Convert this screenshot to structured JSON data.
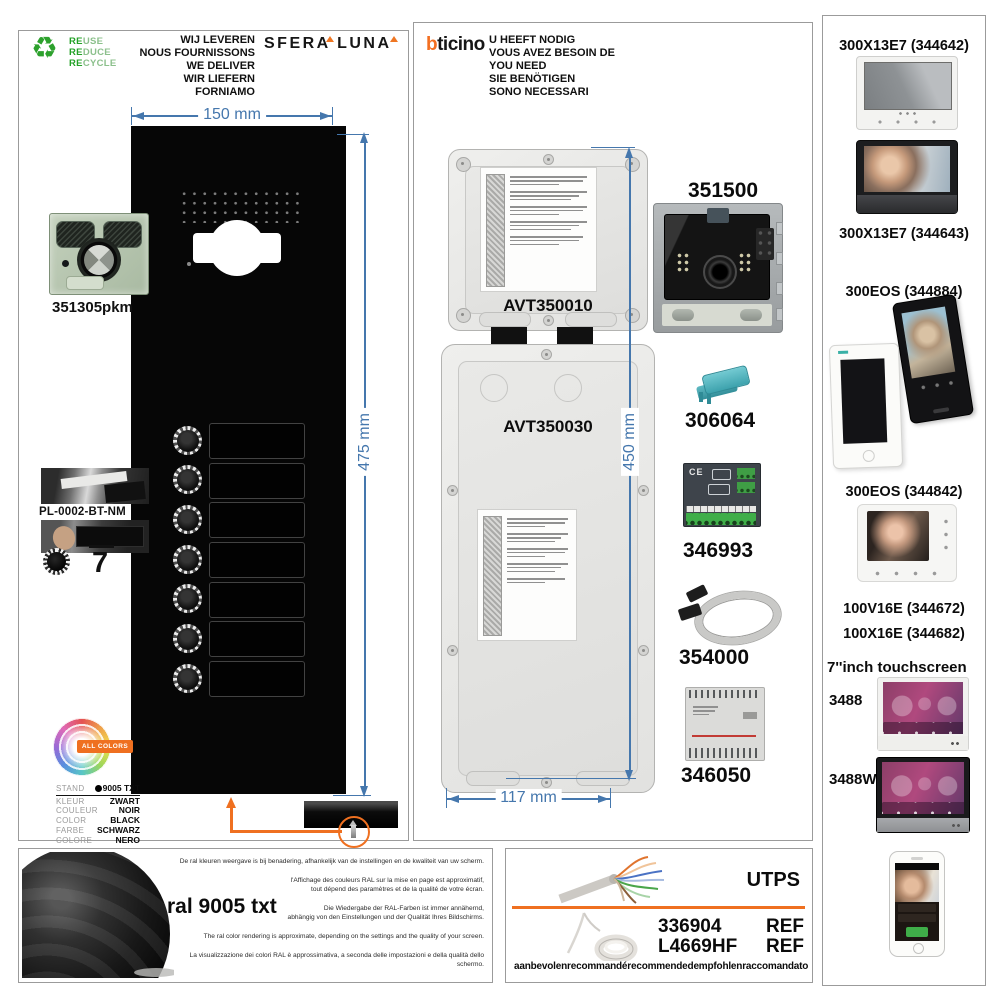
{
  "left_panel": {
    "recycle_lines": [
      {
        "prefix": "RE",
        "rest": "USE"
      },
      {
        "prefix": "RE",
        "rest": "DUCE"
      },
      {
        "prefix": "RE",
        "rest": "CYCLE"
      }
    ],
    "deliver_lines": [
      "WIJ LEVEREN",
      "NOUS FOURNISSONS",
      "WE DELIVER",
      "WIR LIEFERN",
      "FORNIAMO"
    ],
    "brand_logo": "SFERA LUNA",
    "width_dim": "150 mm",
    "height_dim": "475 mm",
    "camera_module_ref": "351305pkm",
    "nameplate_kit_ref": "PL-0002-BT-NM",
    "button_count": "7",
    "all_colors_badge": "ALL COLORS",
    "color_rows": [
      {
        "label": "STAND",
        "value": "9005 TXT"
      },
      {
        "label": "KLEUR",
        "value": "ZWART"
      },
      {
        "label": "COULEUR",
        "value": "NOIR"
      },
      {
        "label": "COLOR",
        "value": "BLACK"
      },
      {
        "label": "FARBE",
        "value": "SCHWARZ"
      },
      {
        "label": "COLORE",
        "value": "NERO"
      }
    ]
  },
  "middle_panel": {
    "brand_logo": {
      "first_letter": "b",
      "rest": "ticino"
    },
    "need_lines": [
      "U HEEFT NODIG",
      "VOUS AVEZ BESOIN DE",
      "YOU NEED",
      "SIE BENÖTIGEN",
      "SONO NECESSARI"
    ],
    "box_top_ref": "AVT350010",
    "box_bottom_ref": "AVT350030",
    "height_dim": "450 mm",
    "width_dim": "117 mm",
    "pcb_ce_mark": "CE",
    "parts": [
      "351500",
      "306064",
      "346993",
      "354000",
      "346050"
    ]
  },
  "right_panel": {
    "items": [
      "300X13E7 (344642)",
      "300X13E7 (344643)",
      "300EOS (344884)",
      "300EOS (344842)",
      "100V16E (344672)",
      "100X16E (344682)",
      "7''inch touchscreen",
      "3488",
      "3488W"
    ]
  },
  "bottom_left_panel": {
    "color_name": "ral 9005 txt",
    "disclaimers": [
      "De ral kleuren weergave is bij benadering, afhankelijk van de instellingen en de kwaliteit van uw scherm.",
      "l'Affichage des couleurs RAL sur la mise en page est approximatif,",
      "tout dépend des paramètres et de la qualité de votre écran.",
      "Die Wiedergabe der RAL-Farben ist immer annähernd,",
      "abhängig von den Einstellungen und der Qualität Ihres Bildschirms.",
      "The ral color rendering is approximate, depending on the settings and the quality of your screen.",
      "La visualizzazione dei colori RAL è approssimativa, a seconda delle impostazioni e della qualità dello schermo."
    ]
  },
  "bottom_middle_panel": {
    "cable_type": "UTPS",
    "refs": [
      {
        "number": "336904",
        "label": "REF"
      },
      {
        "number": "L4669HF",
        "label": "REF"
      }
    ],
    "recommended_words": [
      "aanbevolen",
      "recommandé",
      "recommended",
      "empfohlen",
      "raccomandato"
    ]
  },
  "colors": {
    "dimension_blue": "#4577ad",
    "accent_orange": "#ef7020",
    "brand_orange": "#f36f21",
    "recycle_green": "#2da12d"
  }
}
